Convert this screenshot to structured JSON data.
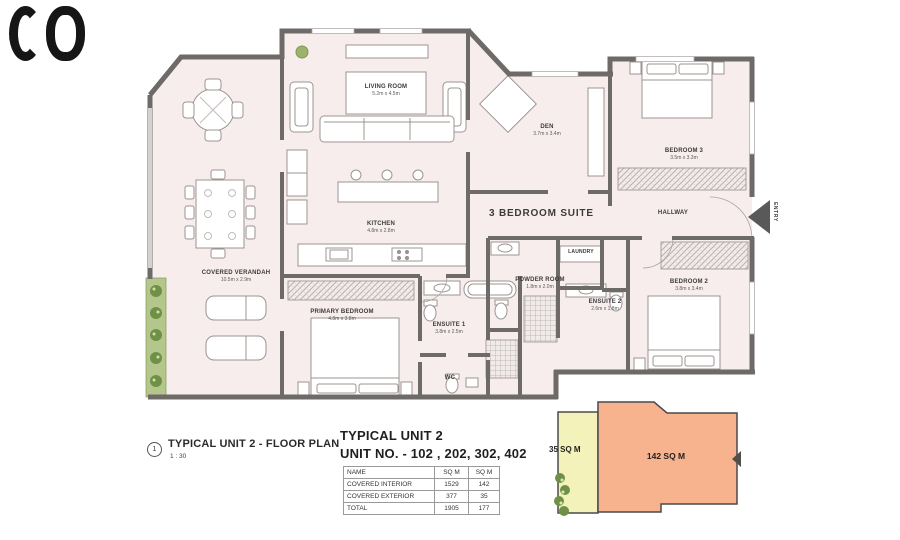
{
  "logo": {
    "icon": "brand-mark"
  },
  "plan": {
    "suite_label": "3 BEDROOM SUITE",
    "entry_label": "ENTRY",
    "rooms": [
      {
        "name": "LIVING ROOM",
        "dims": "5.2m x 4.5m"
      },
      {
        "name": "DEN",
        "dims": "3.7m x 3.4m"
      },
      {
        "name": "BEDROOM 3",
        "dims": "3.5m x 3.3m"
      },
      {
        "name": "HALLWAY",
        "dims": ""
      },
      {
        "name": "KITCHEN",
        "dims": "4.8m x 2.8m"
      },
      {
        "name": "COVERED VERANDAH",
        "dims": "10.5m x 2.9m"
      },
      {
        "name": "PRIMARY BEDROOM",
        "dims": "4.8m x 3.8m"
      },
      {
        "name": "ENSUITE 1",
        "dims": "3.8m x 2.5m"
      },
      {
        "name": "POWDER ROOM",
        "dims": "1.8m x 2.0m"
      },
      {
        "name": "LAUNDRY",
        "dims": ""
      },
      {
        "name": "ENSUITE 2",
        "dims": "2.6m x 1.8m"
      },
      {
        "name": "BEDROOM 2",
        "dims": "3.8m x 3.4m"
      },
      {
        "name": "WC",
        "dims": ""
      }
    ]
  },
  "annotation": {
    "marker_number": "1",
    "title": "TYPICAL UNIT 2 - FLOOR PLAN",
    "scale": "1 : 30"
  },
  "unit_info": {
    "title": "TYPICAL UNIT 2",
    "subtitle": "UNIT NO. - 102 , 202, 302, 402"
  },
  "area_table": {
    "headers": [
      "NAME",
      "SQ M",
      "SQ M"
    ],
    "rows": [
      [
        "COVERED INTERIOR",
        "1529",
        "142"
      ],
      [
        "COVERED EXTERIOR",
        "377",
        "35"
      ],
      [
        "TOTAL",
        "1905",
        "177"
      ]
    ]
  },
  "key_plan": {
    "exterior_label": "35 SQ M",
    "interior_label": "142 SQ M"
  },
  "colors": {
    "floor": "#f7edec",
    "wall": "#6d6a68",
    "key_yellow": "#f4f2bb",
    "key_salmon": "#f7b28e",
    "planter": "#b5c68c"
  }
}
